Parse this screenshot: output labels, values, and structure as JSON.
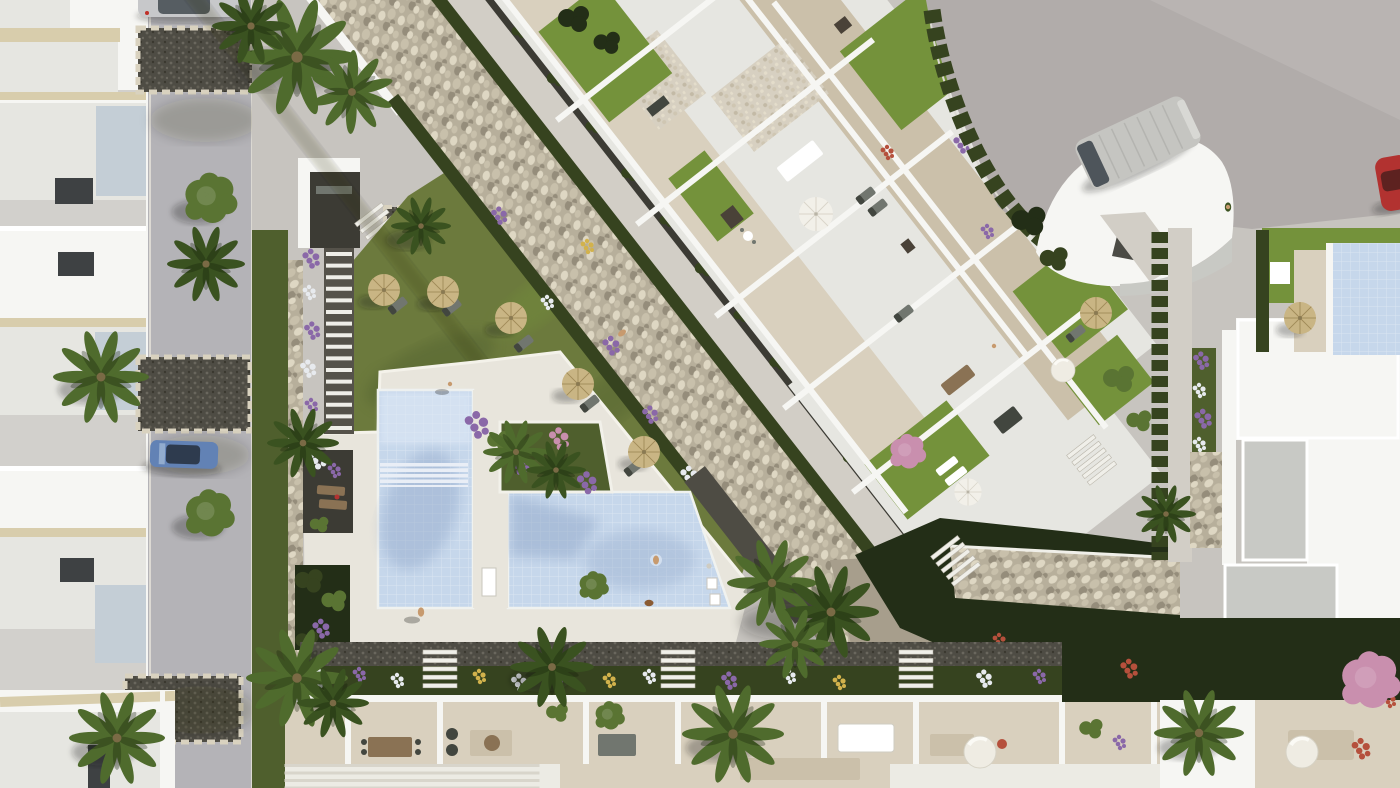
{
  "palette": {
    "pavement": "#c7c4bf",
    "roadLeft": "#b4b3b7",
    "roadTop": "#b1acaa",
    "deck": "#e8e5dc",
    "walk": "#d2cec6",
    "tile": "#d9d0be",
    "tileDark": "#cbc0aa",
    "whiteWall": "#f6f6f3",
    "wallFace": "#e6e6e1",
    "wallShade": "#c8c9c4",
    "grayRoof": "#c8c9c5",
    "beigeTrim": "#d8cdac",
    "glass": "#c4ced6",
    "darkDoor": "#3e4143",
    "gravelDark": "#4e4c44",
    "soil": "#3c3b34",
    "gravelWhite": "#d7d0c1",
    "stoneBase": "#b7af9b",
    "stoneLight": "#ded7c3",
    "stoneMid": "#c8c0ab",
    "stoneDark": "#958d7b",
    "boulder": "#a79e8c",
    "lawn": "#6c7a3d",
    "lawnBright": "#74923b",
    "lawnDark": "#4f5f2d",
    "hedge": "#36431f",
    "hedgeDark": "#232e17",
    "palmLight": "#4f6b2d",
    "palmDark": "#3a5220",
    "treeGreen": "#5a7433",
    "poolWater": "#c6d7eb",
    "poolLight": "#e0eaf7",
    "poolShadow": "#8fa6c8",
    "strawUmbrella": "#c9b584",
    "strawRib": "#a08a58",
    "parasolWhite": "#f2f0e9",
    "furniture": "#71766f",
    "furnitureDark": "#42463f",
    "acUnit": "#4a4238",
    "wood": "#8a7254",
    "flowerPurple": "#8a68a8",
    "flowerWhite": "#e7eaee",
    "flowerYellow": "#d2b24c",
    "flowerPink": "#c98fae",
    "coral": "#b5503c",
    "carBlue": "#6282b5",
    "carSilver": "#c7c8ca",
    "vanBody": "#c5c5c1",
    "carRed": "#b23230",
    "skin": "#c79a6e",
    "white": "#ffffff"
  },
  "scene": {
    "setting": "Aerial 3D architectural render of a white residential resort complex with communal pool, dry stone riverbed, lawns, palm trees and surrounding streets",
    "areas": [
      {
        "name": "left-street",
        "objects": [
          "row of white townhouses with rooftop terraces",
          "asphalt street",
          "silver parked car",
          "blue parked car",
          "gravel driveways with stone borders",
          "palm trees",
          "round trees"
        ]
      },
      {
        "name": "pool-garden",
        "objects": [
          "L-shaped communal pool with lap lane",
          "palm island with purple flowers",
          "white sun deck",
          "pool steps",
          "outdoor shower",
          "towel cabinets",
          "lawn with straw umbrellas and loungers",
          "stepped garden path",
          "stone boundary wall",
          "bench pockets"
        ]
      },
      {
        "name": "stone-river",
        "objects": [
          "diagonal dry pebble riverbed",
          "clipped hedges",
          "concrete walkway",
          "dark planting strip"
        ]
      },
      {
        "name": "apartment-block",
        "objects": [
          "white apartments with roof terraces",
          "terrace lawns",
          "white pebble courtyards",
          "white parasol",
          "outdoor dining tables",
          "sun loungers",
          "air-conditioning units",
          "planters with purple flowers"
        ]
      },
      {
        "name": "top-right-street",
        "objects": [
          "grey road",
          "silver van",
          "red car at edge",
          "hedge along road",
          "white curved-roof villa",
          "pedestrian"
        ]
      },
      {
        "name": "right-villas",
        "objects": [
          "white flat roofs",
          "grey roof slabs",
          "private plunge pool",
          "straw umbrella",
          "cypress hedge row",
          "stone-clad retaining wall",
          "purple flower borders"
        ]
      },
      {
        "name": "bottom-terraces",
        "objects": [
          "row of terraced homes",
          "dining tables",
          "barbecue",
          "potted plants",
          "white dome parasols",
          "flower bed with purple white and yellow flowers",
          "garden staircases",
          "pergola slats",
          "palm trees",
          "coral shrubs"
        ]
      }
    ],
    "counts": {
      "swimming_pools": 2,
      "straw_umbrellas": 7,
      "white_parasols": 2,
      "dome_parasols": 3,
      "cars": 4,
      "people": 6,
      "dogs": 1,
      "garden_staircases": 7,
      "palm_trees": 16
    }
  }
}
